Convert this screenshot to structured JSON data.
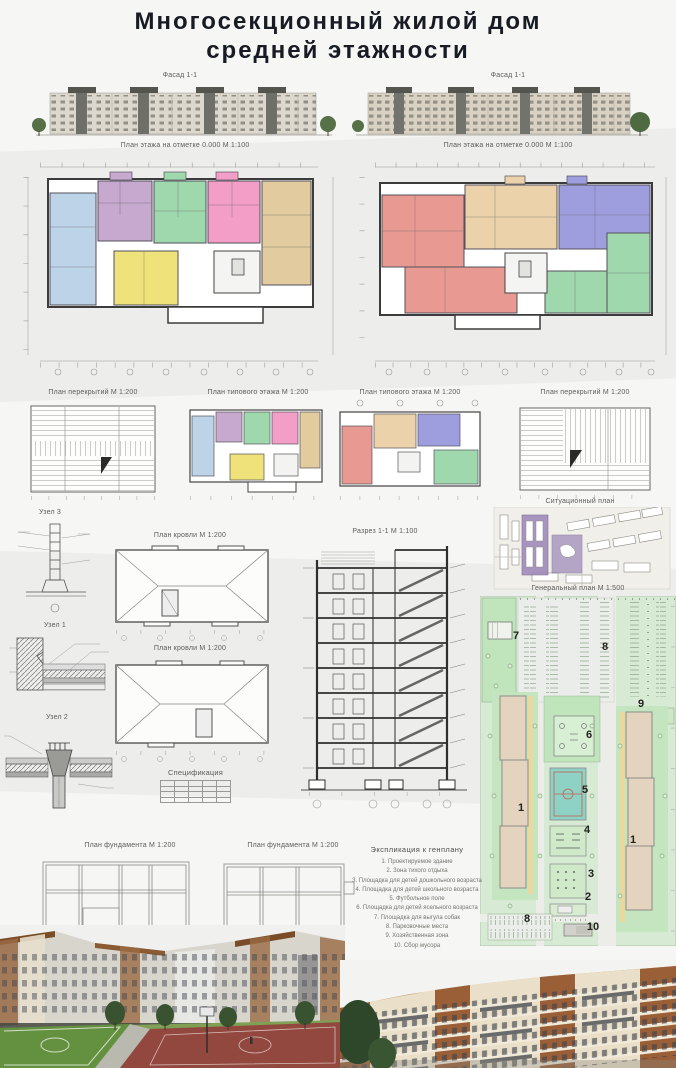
{
  "poster": {
    "title_line1": "Многосекционный жилой дом",
    "title_line2": "средней этажности"
  },
  "labels": {
    "facade_left": "Фасад 1-1",
    "facade_right": "Фасад 1-1",
    "floor_plan_left": "План этажа на отметке 0.000 М 1:100",
    "floor_plan_right": "План этажа на отметке 0.000 М 1:100",
    "slab_plan_left": "План перекрытий М 1:200",
    "typical_floor_left": "План типового этажа М 1:200",
    "typical_floor_right": "План типового этажа М 1:200",
    "slab_plan_right": "План перекрытий М 1:200",
    "situational_plan": "Ситуационный план",
    "node3": "Узел 3",
    "node1": "Узел 1",
    "node2": "Узел 2",
    "roof_plan_1": "План кровли М 1:200",
    "roof_plan_2": "План кровли М 1:200",
    "section": "Разрез 1-1 М 1:100",
    "master_plan": "Генеральный план М 1:500",
    "specification": "Спецификация",
    "foundation_left": "План фундамента М 1:200",
    "foundation_right": "План фундамента М 1:200"
  },
  "legend": {
    "title": "Экспликация к генплану",
    "items": [
      "1. Проектируемое здание",
      "2. Зона тихого отдыха",
      "3. Площадка для детей дошкольного возраста",
      "4. Площадка для детей школьного возраста",
      "5. Футбольное поле",
      "6. Площадка для детей ясельного возраста",
      "7. Площадка для выгула собак",
      "8. Парковочные места",
      "9. Хозяйственная зона",
      "10. Сбор мусора"
    ]
  },
  "masterplan": {
    "zones": [
      "7",
      "8",
      "9",
      "6",
      "5",
      "1",
      "4",
      "1",
      "3",
      "2",
      "8",
      "10"
    ]
  },
  "palette": {
    "apt_blue": "#bdd3e8",
    "apt_purple": "#c7a8cf",
    "apt_green": "#9fd8ad",
    "apt_pink": "#f29ec6",
    "apt_yellow": "#efe27a",
    "apt_beige": "#e2cb9e",
    "apt_salmon": "#e89a92",
    "apt_tan": "#ecd2ab",
    "apt_violet": "#9e9ede",
    "plan_green": "#d7ead4",
    "court_teal": "#8ed2c6",
    "highlight_purple": "#9b86b8"
  }
}
